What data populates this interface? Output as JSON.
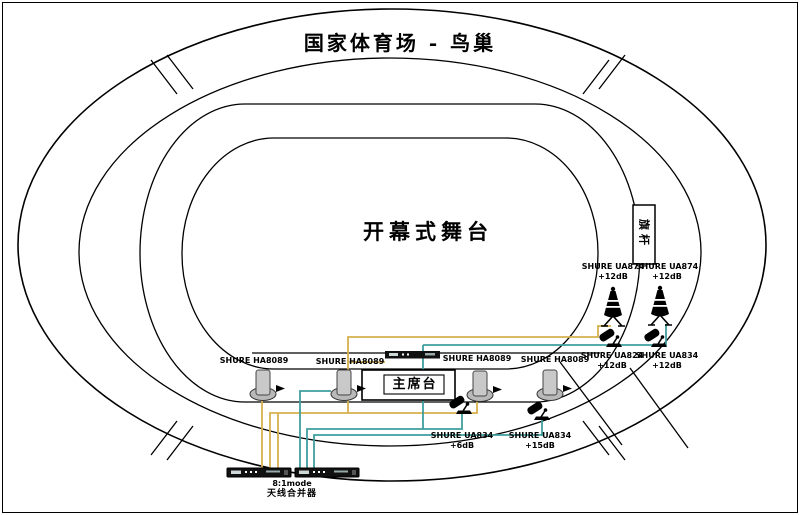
{
  "stadium": {
    "title": "国家体育场 - 鸟巢",
    "stage_label": "开幕式舞台",
    "rostrum_label": "主席台",
    "flagpole_label": "旗杆"
  },
  "equipment": {
    "helical_antennas": [
      {
        "label": "SHURE HA8089"
      },
      {
        "label": "SHURE HA8089"
      },
      {
        "label": "SHURE HA8089"
      },
      {
        "label": "SHURE HA8089"
      }
    ],
    "active_antennas": [
      {
        "model": "SHURE UA874",
        "gain": "+12dB"
      },
      {
        "model": "SHURE UA874",
        "gain": "+12dB"
      }
    ],
    "amps_right": [
      {
        "model": "SHURE UA824",
        "gain": "+12dB"
      },
      {
        "model": "SHURE UA834",
        "gain": "+12dB"
      }
    ],
    "amps_bottom": [
      {
        "model": "SHURE UA834",
        "gain": "+6dB"
      },
      {
        "model": "SHURE UA834",
        "gain": "+15dB"
      }
    ],
    "combiner": {
      "mode_label": "8:1mode",
      "name_label": "天线合并器"
    }
  },
  "icons": {
    "helical-antenna-icon": "grey cylinder on elliptical base with right arrow",
    "active-antenna-icon": "black bell antenna on A-frame stand",
    "paddle-antenna-icon": "angled black paddle on small desk stand",
    "combiner-unit-icon": "black 1U rack bar with white ports",
    "receiver-unit-icon": "black rack bar"
  },
  "colors": {
    "line": "#000000",
    "cable_yellow": "#d6b14e",
    "cable_teal": "#3f9f9f",
    "background": "#ffffff"
  }
}
